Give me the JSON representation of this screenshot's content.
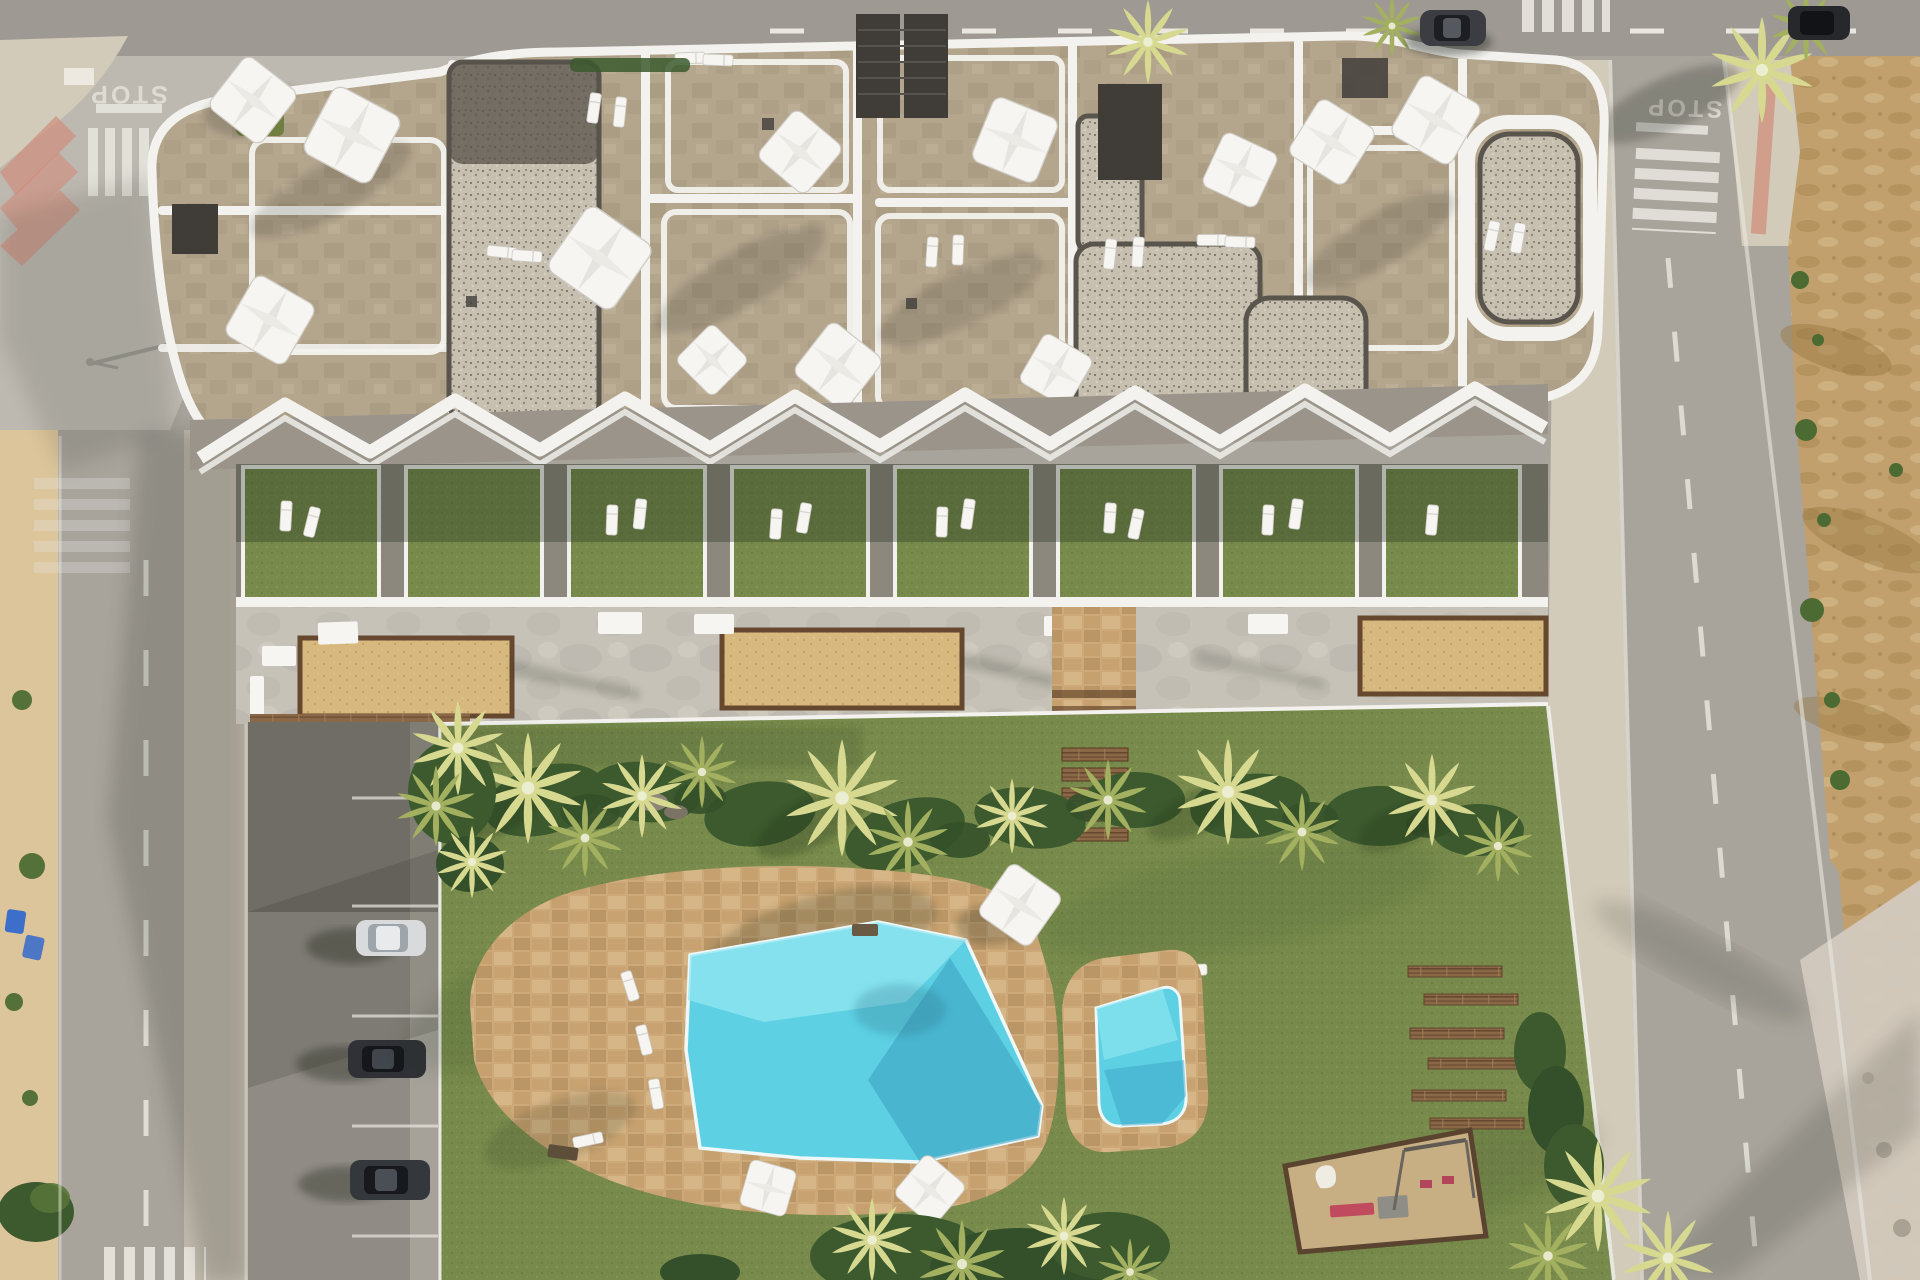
{
  "road_markings": {
    "left_stop": "STOP",
    "right_stop": "STOP"
  },
  "colors": {
    "road": "#a8a49c",
    "road_top": "#9e9a93",
    "road_light": "#bdb9b1",
    "road_shadow": "#84817b",
    "sidewalk": "#d3cbba",
    "sidewalk_pink": "#cf9280",
    "dirt": "#c2a06d",
    "dirt_dark": "#97753f",
    "dirt_light": "#dcc59b",
    "rubble": "#d2cabf",
    "building_stone": "#b4a58d",
    "building_stone_dark": "#9a8b72",
    "parapet_white": "#f3f2ee",
    "gravel": "#c7bfb0",
    "gravel_dark": "#59544c",
    "pergola_dark": "#403d39",
    "roof_green": "#6f7f3f",
    "grass": "#788b4c",
    "grass_dark": "#5c7037",
    "grass_light": "#8ea25a",
    "hedge": "#3c5a2e",
    "shrub": "#34502a",
    "palm": "#d7d990",
    "palm_dark": "#a2b060",
    "pool_stone": "#cda97a",
    "pool_stone_dark": "#ab8757",
    "water": "#5ed0e3",
    "water_light": "#93e7f2",
    "water_dark": "#389fc0",
    "wood": "#8a6847",
    "wood_dark": "#66482e",
    "deck": "#c6c2b8",
    "deck_shadow": "#9c9890",
    "planter_sand": "#d7b97f",
    "furniture_white": "#f6f5f2",
    "play_sand": "#c8ae83",
    "play_pink": "#c04a5e",
    "car_silver": "#d9dadb",
    "car_dark": "#2f3136",
    "bin_blue": "#3d6ec9",
    "marking_white": "#e9e7e0"
  }
}
